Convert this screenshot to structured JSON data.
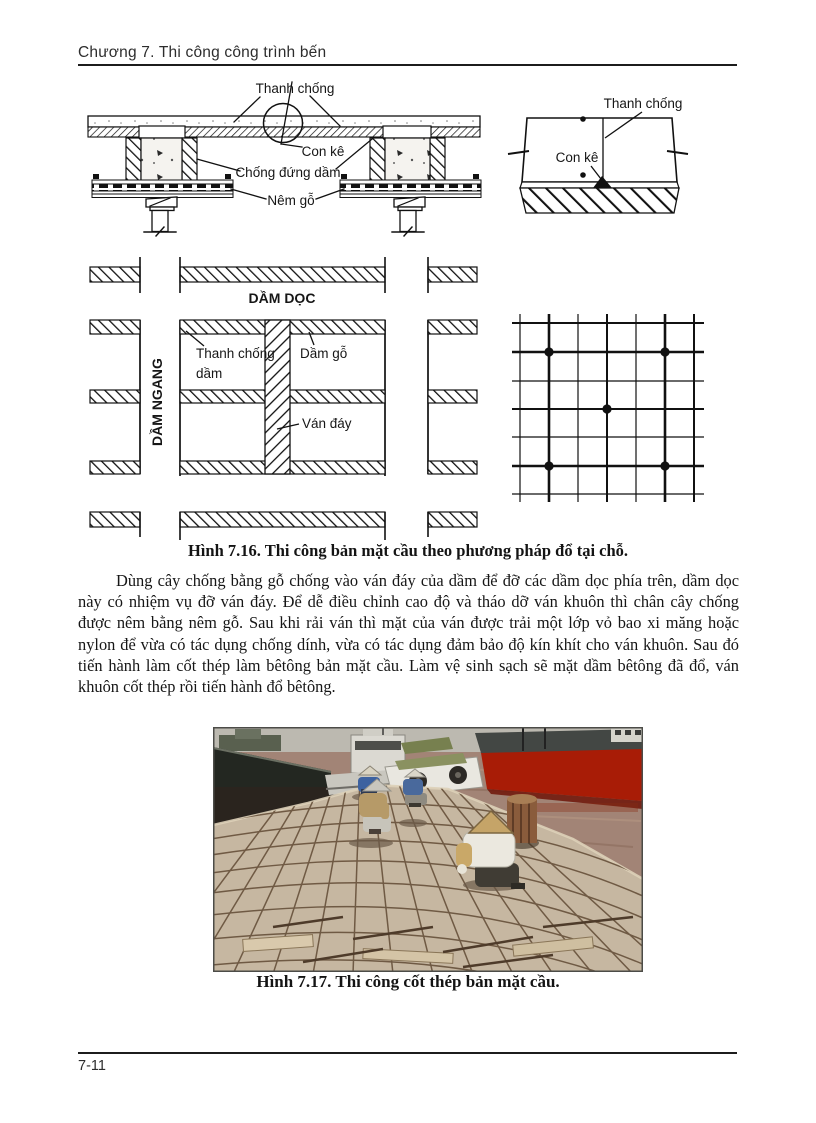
{
  "header": {
    "chapter_title": "Chương 7. Thi công công trình bến"
  },
  "figure_7_16": {
    "caption": "Hình 7.16. Thi công bản mặt cầu theo phương pháp đổ tại chỗ.",
    "section_labels": {
      "thanh_chong": "Thanh chống",
      "con_ke": "Con kê",
      "chong_dung_dam": "Chống đứng dầm",
      "nem_go": "Nêm gỗ"
    },
    "plan_labels": {
      "dam_doc": "DẦM DỌC",
      "dam_ngang": "DẦM NGANG",
      "thanh_chong_dam_l1": "Thanh chống",
      "thanh_chong_dam_l2": "dầm",
      "dam_go": "Dầm gỗ",
      "van_day": "Ván đáy"
    },
    "detail_labels": {
      "thanh_chong": "Thanh chống",
      "con_ke": "Con kê"
    }
  },
  "body": {
    "paragraph": "Dùng cây chống bằng gỗ chống vào ván đáy của dầm để đỡ các dầm dọc phía trên, dầm dọc này có nhiệm vụ đỡ ván đáy. Để dễ điều chỉnh cao độ và tháo dỡ ván khuôn thì chân cây chống được nêm bằng nêm gỗ. Sau khi rải ván thì mặt của ván được trải một lớp vỏ bao xi măng hoặc nylon để vừa có tác dụng chống dính, vừa có tác dụng đảm bảo độ kín khít cho ván khuôn. Sau đó tiến hành làm cốt thép làm bêtông bản mặt cầu. Làm vệ sinh sạch sẽ mặt dầm bêtông đã đổ, ván khuôn cốt thép rồi tiến hành đổ bêtông."
  },
  "figure_7_17": {
    "caption": "Hình 7.17. Thi công cốt thép bản mặt cầu."
  },
  "footer": {
    "page_number": "7-11"
  },
  "colors": {
    "ink": "#161616",
    "photo_water": "#a28476",
    "photo_ship_hull_red": "#a81c06",
    "photo_deck": "#c6b7a1",
    "photo_sky": "#bcb9b0"
  }
}
